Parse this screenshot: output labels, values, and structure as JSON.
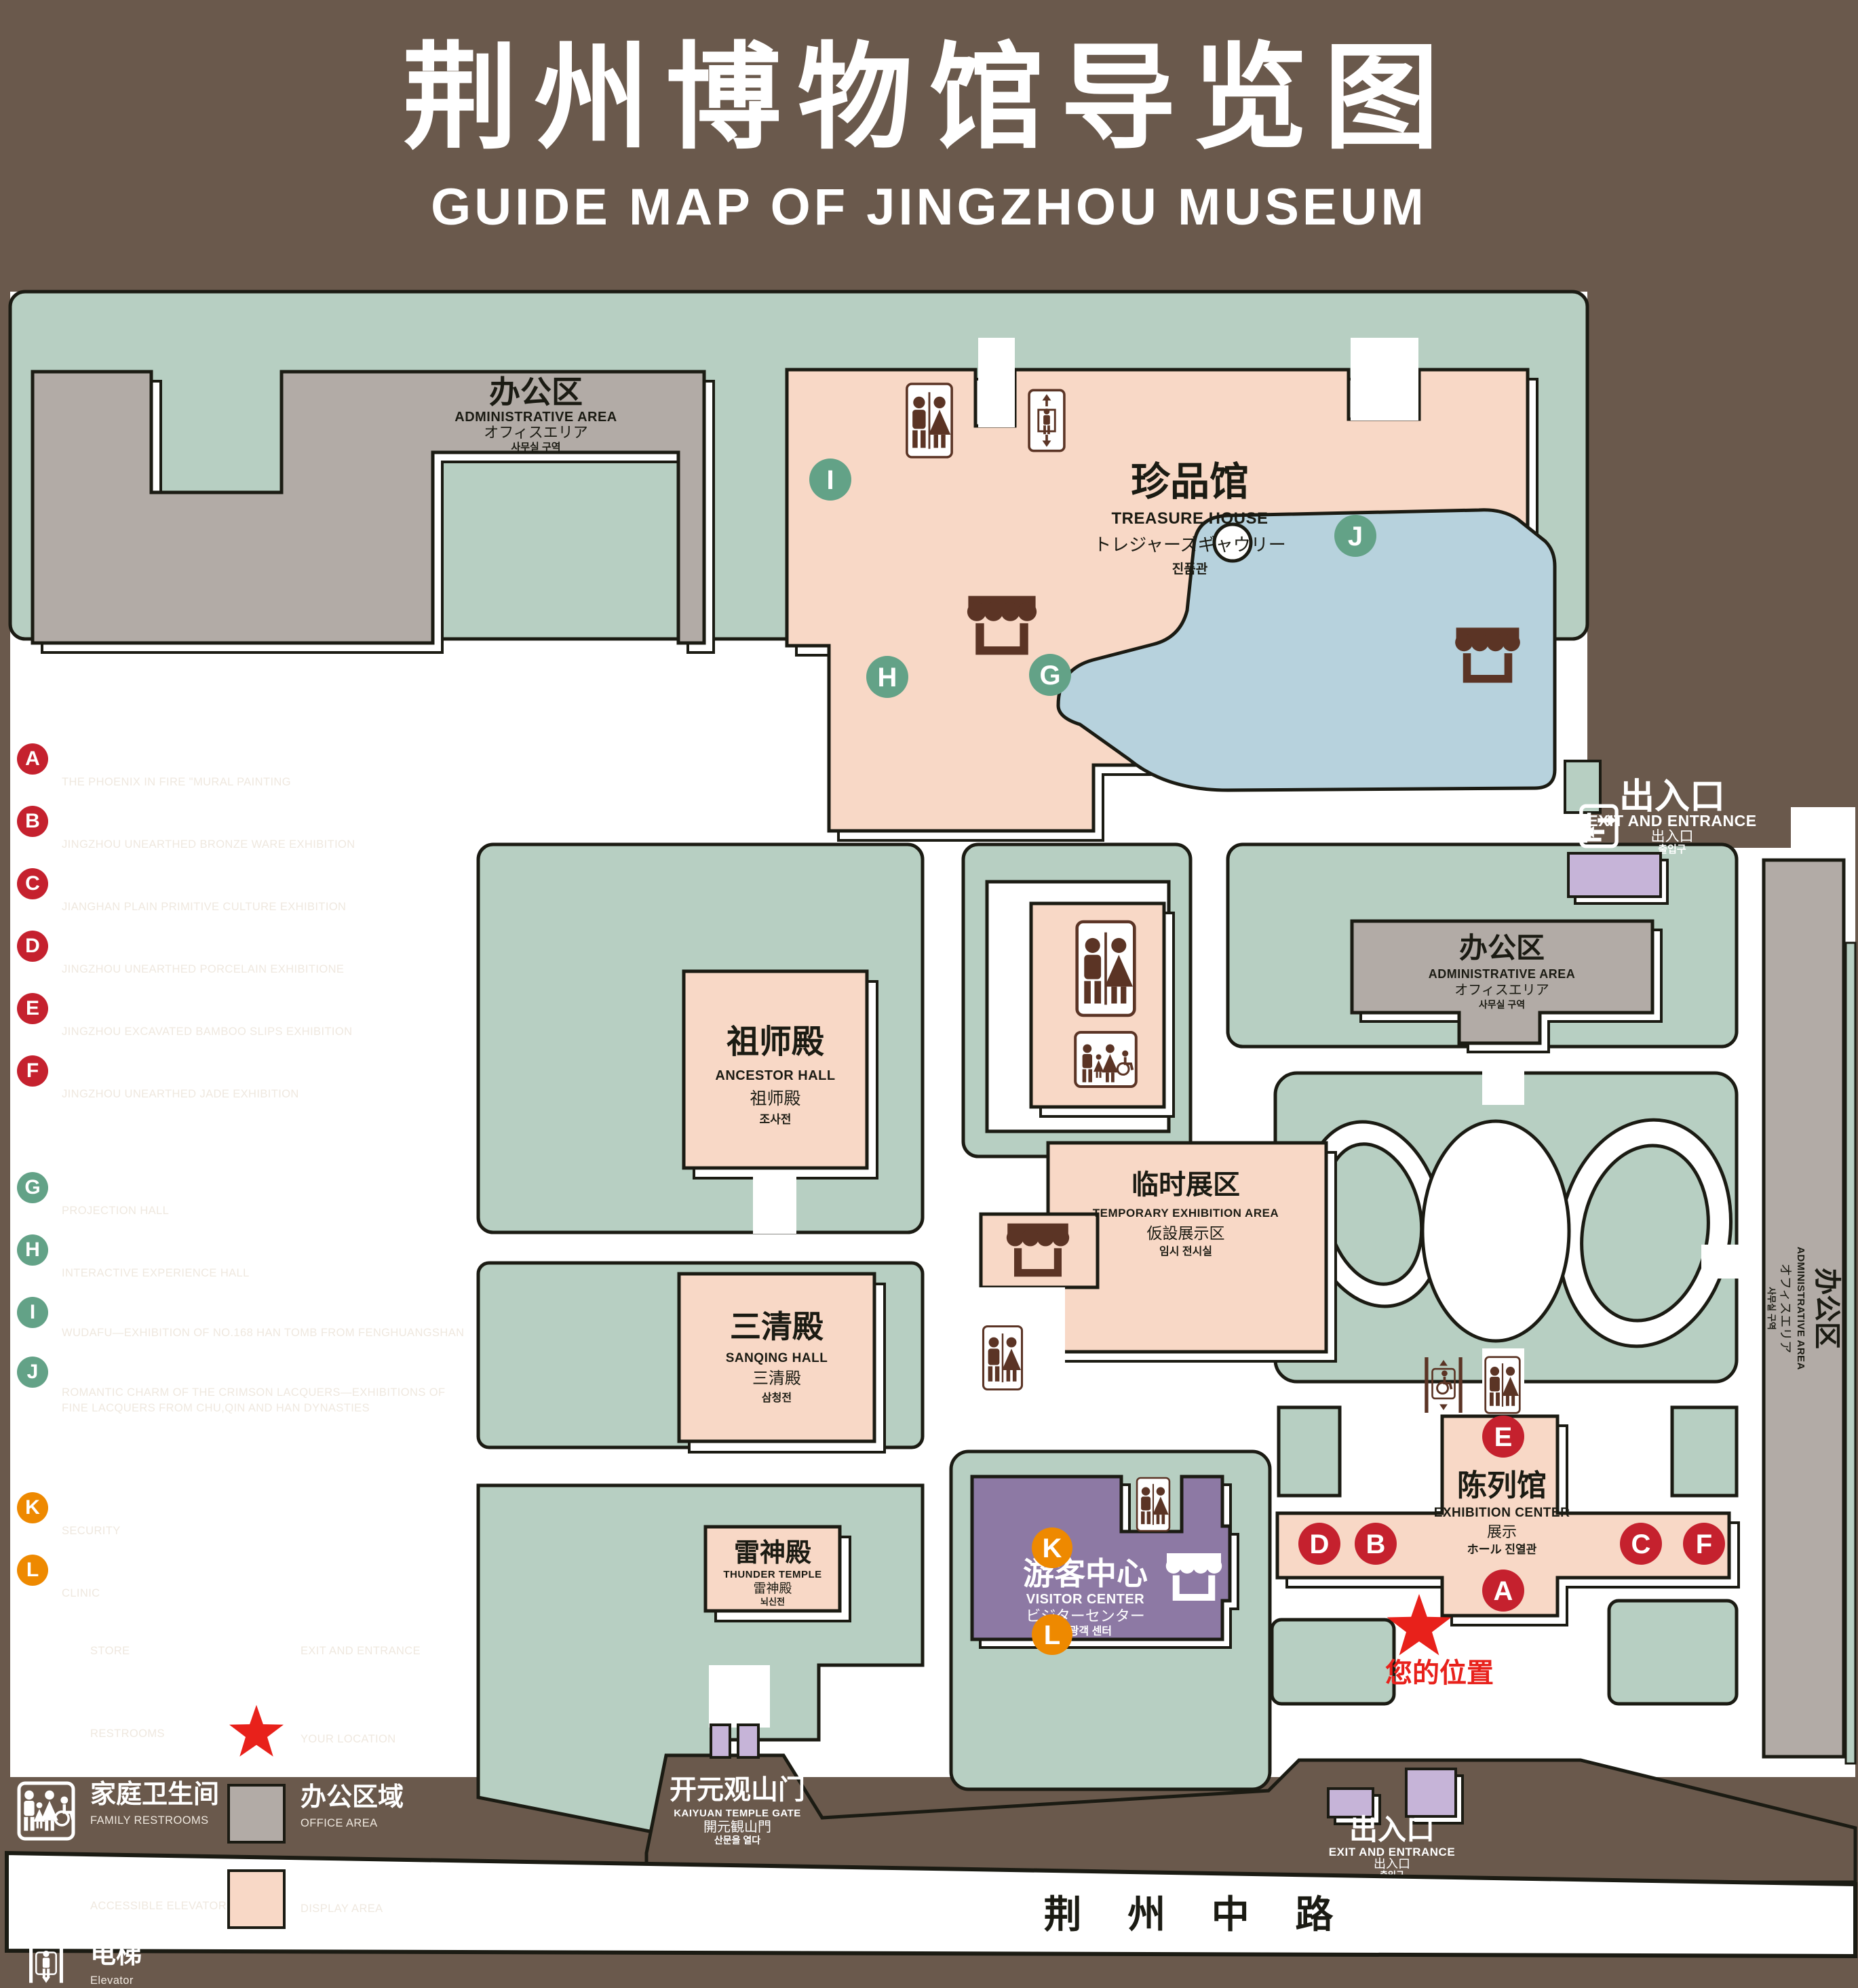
{
  "title": {
    "zh": "荆州博物馆导览图",
    "en": "GUIDE MAP OF JINGZHOU MUSEUM"
  },
  "colors": {
    "background": "#6a594c",
    "lawn_green": "#b7cfc2",
    "display_pink": "#f8d8c6",
    "office_gray": "#b2aba6",
    "pond_blue": "#b7d2dd",
    "visitor_purple": "#8d79a4",
    "gate_purple": "#c6b4d8",
    "icon_brown": "#5b3425",
    "badge_red": "#c5212e",
    "badge_green": "#63a287",
    "badge_orange": "#ee8900",
    "location_red": "#e8211b",
    "outline_black": "#1b1b13"
  },
  "legend": {
    "sections": [
      {
        "zh": "陈列馆",
        "en": "EXHIBITION CENTER",
        "items": [
          {
            "letter": "A",
            "zh": "《火中的凤凰》壁画",
            "en": "THE PHOENIX IN FIRE \"MURAL PAINTING",
            "floor": "1F"
          },
          {
            "letter": "B",
            "zh": "荆州出土铜器展",
            "en": "JINGZHOU UNEARTHED BRONZE WARE EXHIBITION",
            "floor": "1F"
          },
          {
            "letter": "C",
            "zh": "江汉平原原始文化展",
            "en": "JIANGHAN PLAIN PRIMITIVE CULTURE EXHIBITION",
            "floor": "1F"
          },
          {
            "letter": "D",
            "zh": "荆州出土瓷器展",
            "en": "JINGZHOU UNEARTHED PORCELAIN EXHIBITIONE",
            "floor": "2F"
          },
          {
            "letter": "E",
            "zh": "荆州出土简牍展",
            "en": "JINGZHOU EXCAVATED BAMBOO SLIPS EXHIBITION",
            "floor": "2F"
          },
          {
            "letter": "F",
            "zh": "荆州出土玉器展",
            "en": "JINGZHOU UNEARTHED JADE EXHIBITION",
            "floor": "2F"
          }
        ]
      },
      {
        "zh": "珍品馆",
        "en": "TREASURE HOUSE",
        "items": [
          {
            "letter": "G",
            "zh": "放映厅",
            "en": "PROJECTION HALL",
            "floor": "1F"
          },
          {
            "letter": "H",
            "zh": "互动体验厅",
            "en": "INTERACTIVE EXPERIENCE HALL",
            "floor": "1F"
          },
          {
            "letter": "I",
            "zh": "五大夫遂——凤凰山168号汉墓展",
            "en": "WUDAFU—EXHIBITION OF NO.168 HAN TOMB FROM FENGHUANGSHAN",
            "floor": "2F"
          },
          {
            "letter": "J",
            "zh": "丹漆神韵——楚秦汉漆器精品展",
            "en": "ROMANTIC CHARM OF THE CRIMSON LACQUERS—EXHIBITIONS OF FINE LACQUERS FROM CHU,QIN AND HAN DYNASTIES",
            "floor": "1-2F"
          }
        ]
      },
      {
        "zh": "游客中心",
        "en": "VISITOR CENTER",
        "items": [
          {
            "letter": "K",
            "zh": "安全保卫",
            "en": "SECURITY",
            "floor": "1F"
          },
          {
            "letter": "L",
            "zh": "医疗点",
            "en": "CLINIC",
            "floor": "1F"
          }
        ]
      }
    ],
    "symbols": {
      "left": [
        {
          "icon": "store-icon",
          "zh": "文创商店",
          "en": "STORE"
        },
        {
          "icon": "restrooms-icon",
          "zh": "卫生间",
          "en": "RESTROOMS"
        },
        {
          "icon": "family-restrooms-icon",
          "zh": "家庭卫生间",
          "en": "FAMILY RESTROOMS"
        },
        {
          "icon": "accessible-elevator-icon",
          "zh": "无障碍电梯",
          "en": "ACCESSIBLE ELEVATOR"
        },
        {
          "icon": "elevator-icon",
          "zh": "电梯",
          "en": "Elevator"
        }
      ],
      "right": [
        {
          "icon": "exit-entrance-icon",
          "zh": "出入口",
          "en": "EXIT AND ENTRANCE"
        },
        {
          "icon": "your-location-icon",
          "zh": "您的位置",
          "en": "YOUR LOCATION"
        },
        {
          "icon": "office-area-swatch",
          "zh": "办公区域",
          "en": "OFFICE AREA"
        },
        {
          "icon": "display-area-swatch",
          "zh": "展示区域",
          "en": "DISPLAY AREA"
        }
      ]
    }
  },
  "map": {
    "admin": {
      "zh": "办公区",
      "en": "ADMINISTRATIVE AREA",
      "jp": "オフィスエリア",
      "kr": "사무실 구역"
    },
    "treasure": {
      "zh": "珍品馆",
      "en": "TREASURE HOUSE",
      "jp": "トレジャーズギャウリー",
      "kr": "진품관"
    },
    "ancestor": {
      "zh": "祖师殿",
      "en": "ANCESTOR HALL",
      "jp": "祖师殿",
      "kr": "조사전"
    },
    "temporary": {
      "zh": "临时展区",
      "en": "TEMPORARY EXHIBITION AREA",
      "jp": "仮設展示区",
      "kr": "임시 전시실"
    },
    "sanqing": {
      "zh": "三清殿",
      "en": "SANQING HALL",
      "jp": "三清殿",
      "kr": "삼청전"
    },
    "thunder": {
      "zh": "雷神殿",
      "en": "THUNDER TEMPLE",
      "jp": "雷神殿",
      "kr": "뇌신전"
    },
    "visitor": {
      "zh": "游客中心",
      "en": "VISITOR CENTER",
      "jp": "ビジターセンター",
      "kr": "관광객 센터"
    },
    "exhibition": {
      "zh": "陈列馆",
      "en": "EXHIBITION CENTER",
      "jp": "展示",
      "kr": "ホール 진열관"
    },
    "exit": {
      "zh": "出入口",
      "en": "EXIT AND ENTRANCE",
      "jp": "出入口",
      "kr": "출입구"
    },
    "gate": {
      "zh": "开元观山门",
      "en": "KAIYUAN TEMPLE GATE",
      "jp": "開元観山門",
      "kr": "산문을 열다"
    },
    "road": "荆 州 中 路",
    "your_location": "您的位置",
    "badges": {
      "A": "A",
      "B": "B",
      "C": "C",
      "D": "D",
      "E": "E",
      "F": "F",
      "G": "G",
      "H": "H",
      "I": "I",
      "J": "J",
      "K": "K",
      "L": "L"
    }
  }
}
